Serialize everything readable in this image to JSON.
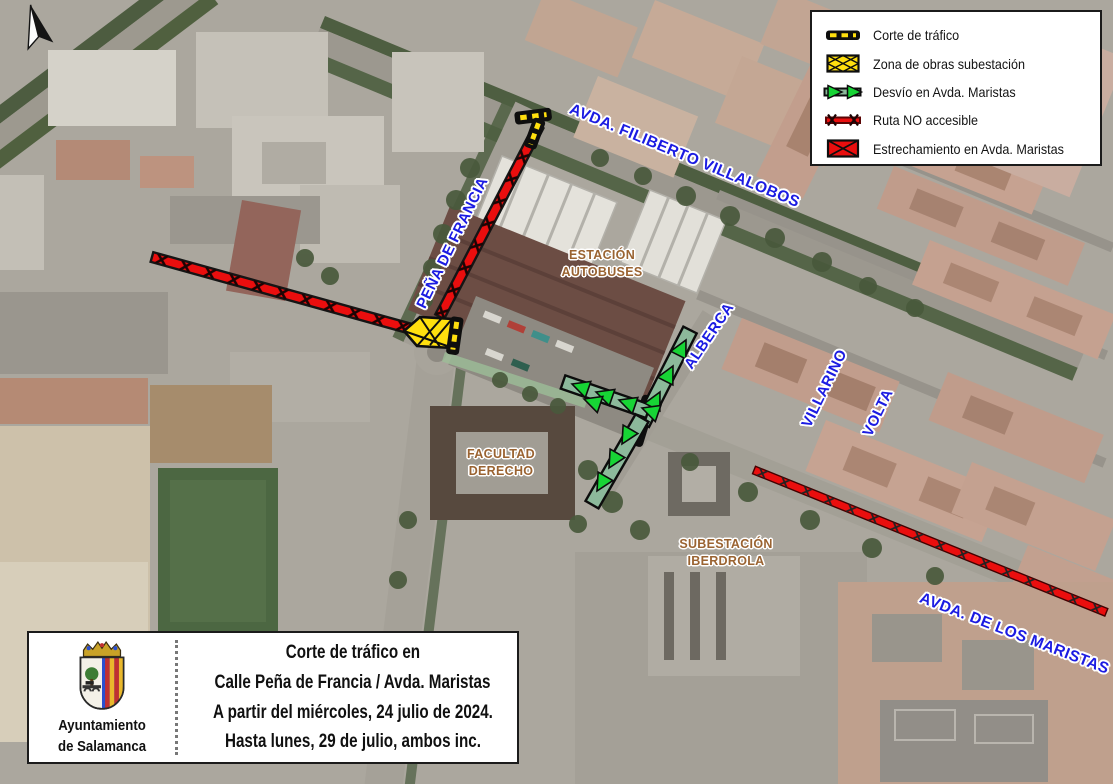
{
  "legend": {
    "items": [
      {
        "icon": "road-closure-icon",
        "label": "Corte de tráfico"
      },
      {
        "icon": "works-zone-icon",
        "label": "Zona de obras subestación"
      },
      {
        "icon": "detour-arrow-icon",
        "label": "Desvío en Avda. Maristas"
      },
      {
        "icon": "route-not-accessible-icon",
        "label": "Ruta NO accesible"
      },
      {
        "icon": "narrowing-icon",
        "label": "Estrechamiento en Avda. Maristas"
      }
    ]
  },
  "map": {
    "street_labels": [
      {
        "name": "avda-filiberto-villalobos",
        "text": "AVDA. FILIBERTO VILLALOBOS"
      },
      {
        "name": "pena-de-francia",
        "text": "PEÑA DE FRANCIA"
      },
      {
        "name": "alberca",
        "text": "ALBERCA"
      },
      {
        "name": "villarino",
        "text": "VILLARINO"
      },
      {
        "name": "volta",
        "text": "VOLTA"
      },
      {
        "name": "avda-de-los-maristas",
        "text": "AVDA. DE LOS MARISTAS"
      }
    ],
    "place_labels": [
      {
        "name": "estacion-autobuses",
        "line1": "ESTACIÓN",
        "line2": "AUTOBUSES"
      },
      {
        "name": "facultad-derecho",
        "line1": "FACULTAD",
        "line2": "DERECHO"
      },
      {
        "name": "subestacion-iberdrola",
        "line1": "SUBESTACIÓN",
        "line2": "IBERDROLA"
      }
    ]
  },
  "info_box": {
    "org_line1": "Ayuntamiento",
    "org_line2": "de Salamanca",
    "title_lines": [
      "Corte de tráfico en",
      "Calle Peña de Francia / Avda. Maristas",
      "A partir del miércoles, 24 julio de 2024.",
      "Hasta lunes, 29 de julio, ambos inc."
    ]
  },
  "colors": {
    "street_label_blue": "#1b1be2",
    "place_label_brown": "#9a6331",
    "closure_red": "#ea0e0e",
    "works_yellow": "#ffdf0e",
    "detour_band_green": "#8cb99b",
    "detour_arrow_green": "#17d435",
    "marker_black": "#0e0e0e"
  }
}
